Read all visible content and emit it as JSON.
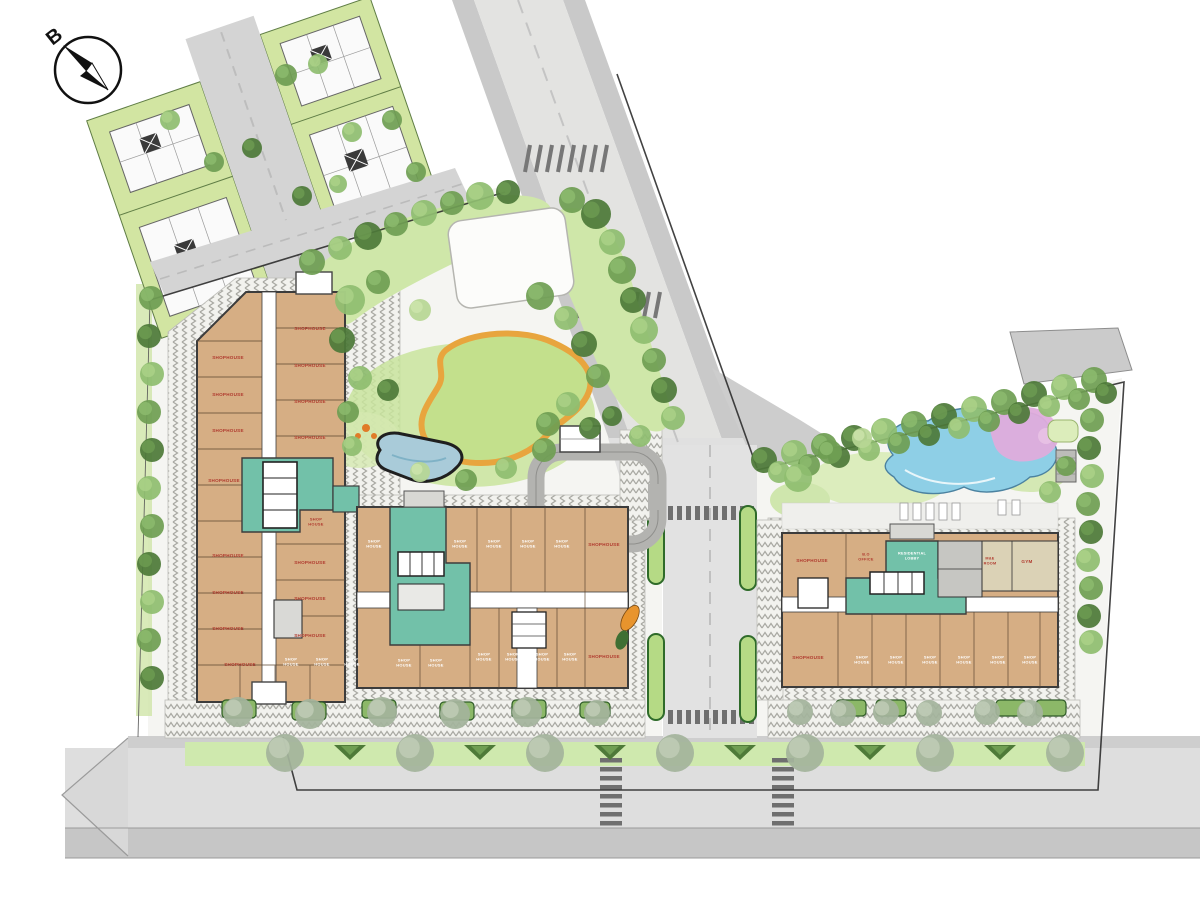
{
  "compass": {
    "label": "B"
  },
  "colors": {
    "building_fill": "#d6ae84",
    "lobby_teal": "#72c1a9",
    "label_red": "#b03a2e",
    "label_white": "#ffffff",
    "pool_blue": "#8ecfe6",
    "pool_pink": "#dfacdc",
    "path_orange": "#e8a53e",
    "tree_palette": [
      "#4e7a39",
      "#6f9e53",
      "#8fbd70",
      "#b7d694",
      "#a4b49c"
    ],
    "tree_highlight": [
      "#6f9e53",
      "#8fbd70",
      "#aed389",
      "#cfe6ad",
      "#c3cfba"
    ]
  },
  "labels": {
    "left_building": [
      [
        228,
        359,
        "SHOPHOUSE",
        "r"
      ],
      [
        228,
        396,
        "SHOPHOUSE",
        "r"
      ],
      [
        228,
        432,
        "SHOPHOUSE",
        "r"
      ],
      [
        224,
        482,
        "SHOPHOUSE",
        "r"
      ],
      [
        228,
        557,
        "SHOPHOUSE",
        "r"
      ],
      [
        228,
        594,
        "SHOPHOUSE",
        "r"
      ],
      [
        228,
        630,
        "SHOPHOUSE",
        "r"
      ],
      [
        310,
        330,
        "SHOPHOUSE",
        "r"
      ],
      [
        310,
        367,
        "SHOPHOUSE",
        "r"
      ],
      [
        310,
        403,
        "SHOPHOUSE",
        "r"
      ],
      [
        310,
        439,
        "SHOPHOUSE",
        "r"
      ],
      [
        316,
        523,
        "SHOP|HOUSE",
        "r",
        4
      ],
      [
        310,
        564,
        "SHOPHOUSE",
        "r"
      ],
      [
        310,
        600,
        "SHOPHOUSE",
        "r"
      ],
      [
        310,
        637,
        "SHOPHOUSE",
        "r"
      ],
      [
        240,
        666,
        "SHOPHOUSE",
        "r"
      ],
      [
        291,
        663,
        "SHOP|HOUSE",
        "w",
        4
      ],
      [
        322,
        663,
        "SHOP|HOUSE",
        "w",
        4
      ],
      [
        352,
        663,
        "SHOP|HOUSE",
        "w",
        4
      ]
    ],
    "central_building": [
      [
        374,
        545,
        "SHOP|HOUSE",
        "w",
        4
      ],
      [
        460,
        545,
        "SHOP|HOUSE",
        "w",
        4
      ],
      [
        494,
        545,
        "SHOP|HOUSE",
        "w",
        4
      ],
      [
        528,
        545,
        "SHOP|HOUSE",
        "w",
        4
      ],
      [
        562,
        545,
        "SHOP|HOUSE",
        "w",
        4
      ],
      [
        604,
        546,
        "SHOPHOUSE",
        "r"
      ],
      [
        404,
        664,
        "SHOP|HOUSE",
        "w",
        4
      ],
      [
        436,
        664,
        "SHOP|HOUSE",
        "w",
        4
      ],
      [
        484,
        658,
        "SHOP|HOUSE",
        "w",
        4
      ],
      [
        513,
        658,
        "SHOP|HOUSE",
        "w",
        4
      ],
      [
        542,
        658,
        "SHOP|HOUSE",
        "w",
        4
      ],
      [
        570,
        658,
        "SHOP|HOUSE",
        "w",
        4
      ],
      [
        604,
        658,
        "SHOPHOUSE",
        "r"
      ]
    ],
    "right_building": [
      [
        812,
        562,
        "SHOPHOUSE",
        "r"
      ],
      [
        866,
        558,
        "B.O|OFFICE",
        "r",
        3.8
      ],
      [
        912,
        557,
        "RESIDENTIAL|LOBBY",
        "w",
        3.8
      ],
      [
        990,
        562,
        "M&E|ROOM",
        "r",
        3.8
      ],
      [
        1027,
        563,
        "GYM",
        "r"
      ],
      [
        808,
        659,
        "SHOPHOUSE",
        "r"
      ],
      [
        862,
        661,
        "SHOP|HOUSE",
        "w",
        4
      ],
      [
        896,
        661,
        "SHOP|HOUSE",
        "w",
        4
      ],
      [
        930,
        661,
        "SHOP|HOUSE",
        "w",
        4
      ],
      [
        964,
        661,
        "SHOP|HOUSE",
        "w",
        4
      ],
      [
        998,
        661,
        "SHOP|HOUSE",
        "w",
        4
      ],
      [
        1030,
        661,
        "SHOP|HOUSE",
        "w",
        4
      ]
    ]
  },
  "landscape": {
    "trees": [
      [
        312,
        262,
        13,
        1
      ],
      [
        340,
        248,
        12,
        2
      ],
      [
        368,
        236,
        14,
        0
      ],
      [
        396,
        224,
        12,
        1
      ],
      [
        424,
        213,
        13,
        2
      ],
      [
        452,
        203,
        12,
        1
      ],
      [
        480,
        196,
        14,
        2
      ],
      [
        508,
        192,
        12,
        0
      ],
      [
        572,
        200,
        13,
        1
      ],
      [
        596,
        214,
        15,
        0
      ],
      [
        612,
        242,
        13,
        2
      ],
      [
        622,
        270,
        14,
        1
      ],
      [
        633,
        300,
        13,
        0
      ],
      [
        644,
        330,
        14,
        2
      ],
      [
        654,
        360,
        12,
        1
      ],
      [
        664,
        390,
        13,
        0
      ],
      [
        673,
        418,
        12,
        2
      ],
      [
        350,
        300,
        15,
        2
      ],
      [
        378,
        282,
        12,
        1
      ],
      [
        342,
        340,
        13,
        0
      ],
      [
        360,
        378,
        12,
        2
      ],
      [
        348,
        412,
        11,
        1
      ],
      [
        420,
        310,
        11,
        3
      ],
      [
        540,
        296,
        14,
        1
      ],
      [
        566,
        318,
        12,
        2
      ],
      [
        584,
        344,
        13,
        0
      ],
      [
        598,
        376,
        12,
        1
      ],
      [
        568,
        404,
        12,
        2
      ],
      [
        590,
        428,
        11,
        0
      ],
      [
        544,
        450,
        12,
        1
      ],
      [
        506,
        468,
        11,
        2
      ],
      [
        466,
        480,
        11,
        1
      ],
      [
        388,
        390,
        11,
        0
      ],
      [
        352,
        446,
        10,
        2
      ],
      [
        420,
        472,
        10,
        3
      ],
      [
        548,
        424,
        12,
        1
      ],
      [
        640,
        436,
        11,
        2
      ],
      [
        612,
        416,
        10,
        0
      ],
      [
        151,
        298,
        12,
        1
      ],
      [
        149,
        336,
        12,
        0
      ],
      [
        152,
        374,
        12,
        2
      ],
      [
        149,
        412,
        12,
        1
      ],
      [
        152,
        450,
        12,
        0
      ],
      [
        149,
        488,
        12,
        2
      ],
      [
        152,
        526,
        12,
        1
      ],
      [
        149,
        564,
        12,
        0
      ],
      [
        152,
        602,
        12,
        2
      ],
      [
        149,
        640,
        12,
        1
      ],
      [
        152,
        678,
        12,
        0
      ],
      [
        286,
        75,
        11,
        1
      ],
      [
        318,
        64,
        10,
        2
      ],
      [
        252,
        148,
        10,
        0
      ],
      [
        214,
        162,
        10,
        1
      ],
      [
        352,
        132,
        10,
        2
      ],
      [
        392,
        120,
        10,
        1
      ],
      [
        302,
        196,
        10,
        0
      ],
      [
        338,
        184,
        9,
        2
      ],
      [
        416,
        172,
        10,
        1
      ],
      [
        170,
        120,
        10,
        2
      ],
      [
        764,
        460,
        13,
        0
      ],
      [
        794,
        453,
        13,
        2
      ],
      [
        824,
        446,
        13,
        1
      ],
      [
        854,
        438,
        13,
        0
      ],
      [
        884,
        431,
        13,
        2
      ],
      [
        914,
        424,
        13,
        1
      ],
      [
        944,
        416,
        13,
        0
      ],
      [
        974,
        409,
        13,
        2
      ],
      [
        1004,
        402,
        13,
        1
      ],
      [
        1034,
        394,
        13,
        0
      ],
      [
        1064,
        387,
        13,
        2
      ],
      [
        1094,
        380,
        13,
        1
      ],
      [
        779,
        472,
        11,
        2
      ],
      [
        809,
        465,
        11,
        1
      ],
      [
        839,
        457,
        11,
        0
      ],
      [
        869,
        450,
        11,
        2
      ],
      [
        899,
        443,
        11,
        1
      ],
      [
        929,
        435,
        11,
        0
      ],
      [
        959,
        428,
        11,
        2
      ],
      [
        989,
        421,
        11,
        1
      ],
      [
        1019,
        413,
        11,
        0
      ],
      [
        1049,
        406,
        11,
        2
      ],
      [
        1079,
        399,
        11,
        1
      ],
      [
        1106,
        393,
        11,
        0
      ],
      [
        1092,
        420,
        12,
        1
      ],
      [
        1089,
        448,
        12,
        0
      ],
      [
        1092,
        476,
        12,
        2
      ],
      [
        1088,
        504,
        12,
        1
      ],
      [
        1091,
        532,
        12,
        0
      ],
      [
        1088,
        560,
        12,
        2
      ],
      [
        1091,
        588,
        12,
        1
      ],
      [
        1089,
        616,
        12,
        0
      ],
      [
        1091,
        642,
        12,
        2
      ],
      [
        798,
        478,
        14,
        2
      ],
      [
        830,
        452,
        12,
        1
      ],
      [
        862,
        438,
        10,
        3
      ],
      [
        1050,
        492,
        11,
        2
      ],
      [
        1066,
        466,
        10,
        1
      ],
      [
        238,
        712,
        15,
        4
      ],
      [
        310,
        714,
        15,
        4
      ],
      [
        382,
        712,
        15,
        4
      ],
      [
        455,
        714,
        15,
        4
      ],
      [
        527,
        712,
        15,
        4
      ],
      [
        597,
        713,
        13,
        4
      ],
      [
        800,
        712,
        13,
        4
      ],
      [
        843,
        713,
        13,
        4
      ],
      [
        886,
        712,
        13,
        4
      ],
      [
        929,
        713,
        13,
        4
      ],
      [
        987,
        712,
        13,
        4
      ],
      [
        1030,
        713,
        13,
        4
      ],
      [
        285,
        753,
        19,
        4
      ],
      [
        415,
        753,
        19,
        4
      ],
      [
        545,
        753,
        19,
        4
      ],
      [
        675,
        753,
        19,
        4
      ],
      [
        805,
        753,
        19,
        4
      ],
      [
        935,
        753,
        19,
        4
      ],
      [
        1065,
        753,
        19,
        4
      ]
    ],
    "bushes": [
      [
        350,
        745
      ],
      [
        480,
        745
      ],
      [
        610,
        745
      ],
      [
        740,
        745
      ],
      [
        870,
        745
      ],
      [
        1000,
        745
      ]
    ]
  }
}
